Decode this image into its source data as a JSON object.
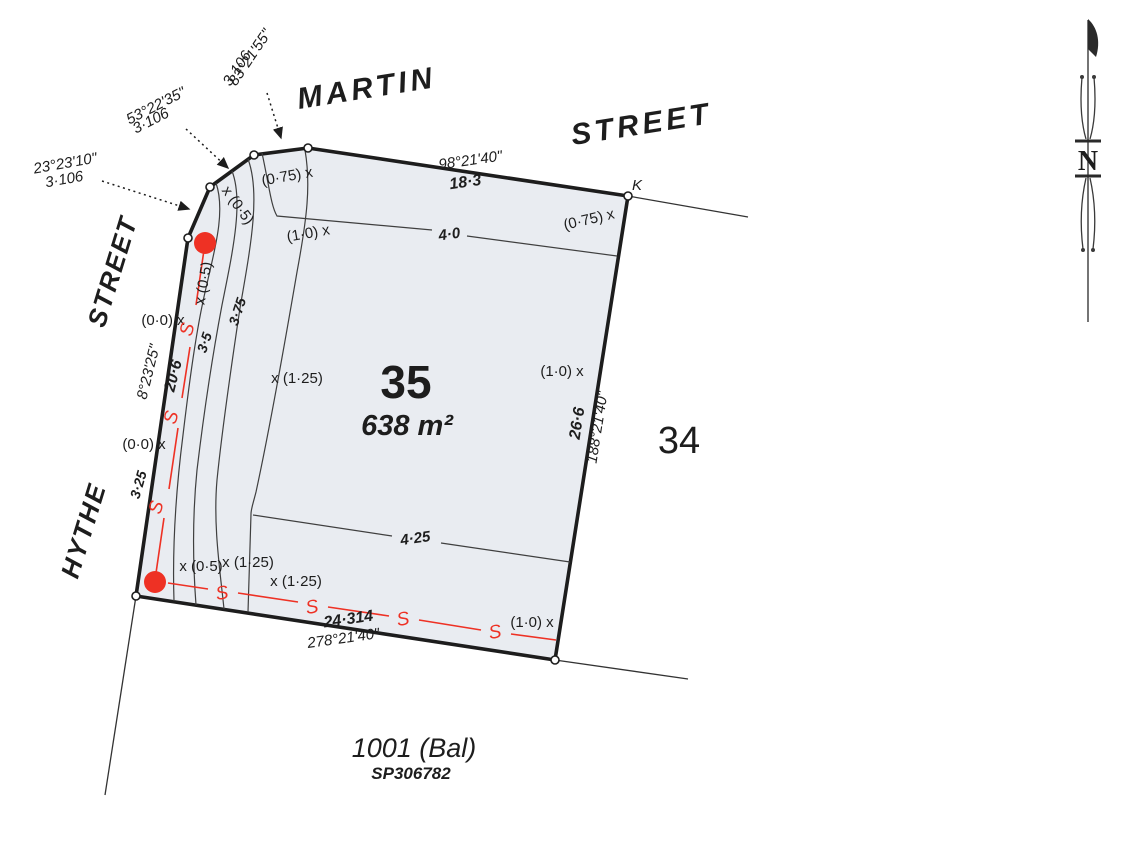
{
  "plan_type": "cadastral-survey-plan",
  "streets": {
    "martin": "MARTIN",
    "martin_street_word": "STREET",
    "hythe": "HYTHE",
    "hythe_street_word": "STREET"
  },
  "lot": {
    "number": "35",
    "area": "638 m²"
  },
  "neighbours": {
    "lot_right": "34",
    "balance_lot": "1001 (Bal)",
    "plan_number": "SP306782"
  },
  "corner_mark": "K",
  "north_label": "N",
  "boundaries": {
    "top": {
      "bearing": "98°21'40\"",
      "distance": "18·3"
    },
    "left": {
      "bearing": "8°23'25\"",
      "distance": "20·6"
    },
    "right": {
      "bearing": "188°21'40\"",
      "distance": "26·6"
    },
    "bottom": {
      "bearing": "278°21'40\"",
      "distance": "24·314"
    }
  },
  "truncations": [
    {
      "bearing": "23°23'10\"",
      "distance": "3·106"
    },
    {
      "bearing": "53°22'35\"",
      "distance": "3·106"
    },
    {
      "bearing": "83°21'55\"",
      "distance": "3·106"
    }
  ],
  "contours": {
    "c325": "3·25",
    "c35": "3·5",
    "c375": "3·75",
    "c40": "4·0",
    "c425": "4·25"
  },
  "spot_levels": [
    {
      "text": "(0·75) x"
    },
    {
      "text": "x (0·5)"
    },
    {
      "text": "x (0·5)"
    },
    {
      "text": "(1·0) x"
    },
    {
      "text": "(0·75) x"
    },
    {
      "text": "(0·0) x"
    },
    {
      "text": "(0·0) x"
    },
    {
      "text": "x (1·25)"
    },
    {
      "text": "(1·0) x"
    },
    {
      "text": "x (0·5)"
    },
    {
      "text": "x (1·25)"
    },
    {
      "text": "x (1·25)"
    },
    {
      "text": "(1·0) x"
    }
  ],
  "sewer": {
    "marker": "S"
  },
  "colors": {
    "lot_fill": "#e9ecf1",
    "line": "#1d1d1d",
    "sewer_red": "#ee3124"
  }
}
